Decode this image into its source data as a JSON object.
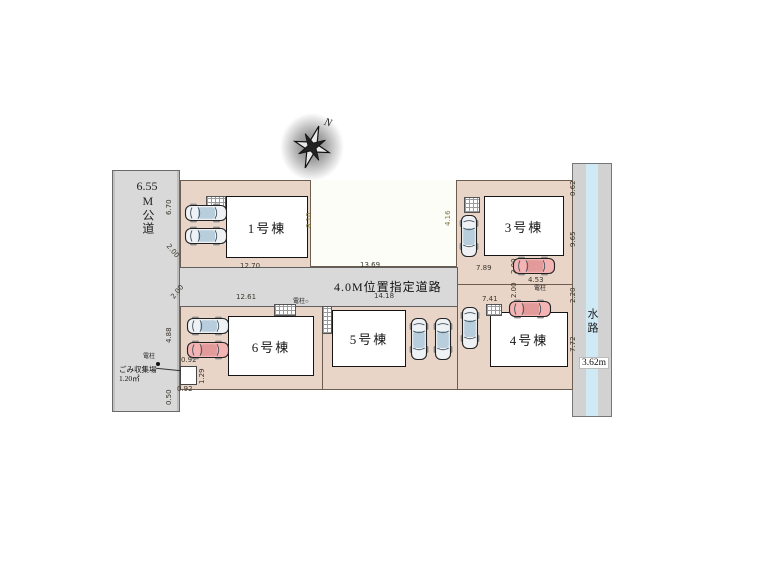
{
  "compass": {
    "label": "N"
  },
  "left_road": {
    "number": "6.55",
    "name": "M公道"
  },
  "center_road": {
    "label": "4.0M位置指定道路"
  },
  "waterway": {
    "label": "水路",
    "width_label": "3.62m"
  },
  "garbage": {
    "label": "ごみ収集場",
    "area": "1.20㎡"
  },
  "buildings": [
    {
      "label": "1号棟"
    },
    {
      "label": "3号棟"
    },
    {
      "label": "4号棟"
    },
    {
      "label": "5号棟"
    },
    {
      "label": "6号棟"
    }
  ],
  "dimensions": [
    {
      "text": "6.70",
      "x": 166,
      "y": 215,
      "rot": -90
    },
    {
      "text": "2.00",
      "x": 170,
      "y": 243,
      "rot": 50
    },
    {
      "text": "12.70",
      "x": 240,
      "y": 263,
      "rot": 0
    },
    {
      "text": "13.69",
      "x": 360,
      "y": 262,
      "rot": 0
    },
    {
      "text": "7.89",
      "x": 476,
      "y": 265,
      "rot": 0
    },
    {
      "text": "8.10",
      "x": 306,
      "y": 228,
      "rot": -90,
      "olive": true
    },
    {
      "text": "4.16",
      "x": 445,
      "y": 226,
      "rot": -90,
      "olive": true
    },
    {
      "text": "12.61",
      "x": 236,
      "y": 294,
      "rot": 0
    },
    {
      "text": "14.18",
      "x": 374,
      "y": 293,
      "rot": 0
    },
    {
      "text": "7.41",
      "x": 482,
      "y": 296,
      "rot": 0
    },
    {
      "text": "2.00",
      "x": 511,
      "y": 274,
      "rot": -90
    },
    {
      "text": "4.53",
      "x": 528,
      "y": 277,
      "rot": 0
    },
    {
      "text": "2.00",
      "x": 511,
      "y": 298,
      "rot": -90
    },
    {
      "text": "7.98",
      "x": 446,
      "y": 352,
      "rot": -90
    },
    {
      "text": "2.00",
      "x": 170,
      "y": 296,
      "rot": -50
    },
    {
      "text": "4.88",
      "x": 166,
      "y": 343,
      "rot": -90
    },
    {
      "text": "0.92",
      "x": 181,
      "y": 357,
      "rot": 0
    },
    {
      "text": "1.29",
      "x": 199,
      "y": 384,
      "rot": -90
    },
    {
      "text": "0.92",
      "x": 177,
      "y": 386,
      "rot": 0
    },
    {
      "text": "0.50",
      "x": 166,
      "y": 405,
      "rot": -90
    },
    {
      "text": "0.62",
      "x": 570,
      "y": 196,
      "rot": -90
    },
    {
      "text": "9.65",
      "x": 570,
      "y": 247,
      "rot": -90
    },
    {
      "text": "2.20",
      "x": 570,
      "y": 303,
      "rot": -90
    },
    {
      "text": "7.72",
      "x": 570,
      "y": 352,
      "rot": -90
    }
  ],
  "poles": [
    {
      "label": "電柱",
      "x": 143,
      "y": 354,
      "dot": true,
      "dx": 156,
      "dy": 362
    },
    {
      "label": "電柱",
      "x": 534,
      "y": 286,
      "dot": false
    },
    {
      "label": "電柱○",
      "x": 293,
      "y": 299,
      "dot": false
    }
  ],
  "cars": [
    {
      "x": 184,
      "y": 203,
      "dir": "h",
      "color": "light"
    },
    {
      "x": 184,
      "y": 226,
      "dir": "h",
      "color": "light"
    },
    {
      "x": 459,
      "y": 214,
      "dir": "v",
      "color": "light"
    },
    {
      "x": 512,
      "y": 256,
      "dir": "h",
      "color": "red"
    },
    {
      "x": 508,
      "y": 299,
      "dir": "h",
      "color": "red"
    },
    {
      "x": 460,
      "y": 306,
      "dir": "v",
      "color": "light"
    },
    {
      "x": 409,
      "y": 317,
      "dir": "v",
      "color": "light"
    },
    {
      "x": 433,
      "y": 317,
      "dir": "v",
      "color": "light"
    },
    {
      "x": 186,
      "y": 316,
      "dir": "h",
      "color": "light"
    },
    {
      "x": 186,
      "y": 340,
      "dir": "h",
      "color": "red"
    }
  ],
  "colors": {
    "lot_pink": "#e9d5c8",
    "road_gray": "#d9d9d9",
    "water_blue": "#cfe9f5",
    "building_white": "#ffffff",
    "car_light_body": "#eef2f5",
    "car_red_body": "#f4b4b4",
    "car_window": "#b9cedd",
    "car_red_window": "#e29a9a",
    "outline": "#222222"
  }
}
